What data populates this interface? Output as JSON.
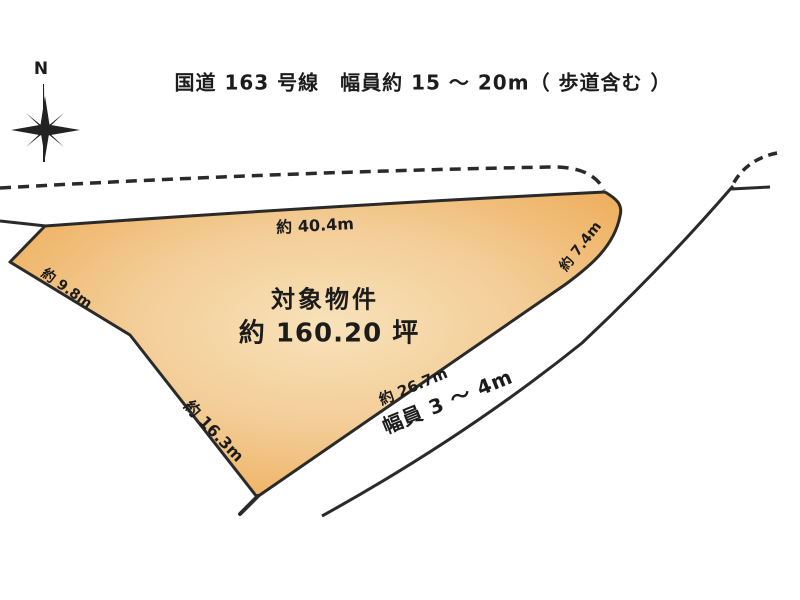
{
  "header": {
    "title": "国道 163 号線　幅員約 15 ～ 20m（ 歩道含む ）"
  },
  "compass": {
    "north_label": "N"
  },
  "parcel": {
    "name": "対象物件",
    "area": "約 160.20 坪",
    "fill_center_color": "#f8e2ba",
    "fill_edge_color": "#eda64d",
    "dimensions": {
      "top_edge": "約 40.4m",
      "right_edge": "約 7.4m",
      "upper_left_edge": "約 9.8m",
      "lower_left_edge": "約 16.3m",
      "bottom_edge": "約 26.7m"
    }
  },
  "roads": {
    "south_road_width_label": "幅員 3 ～ 4m"
  },
  "colors": {
    "line": "#2a2a2a",
    "background": "#ffffff"
  }
}
